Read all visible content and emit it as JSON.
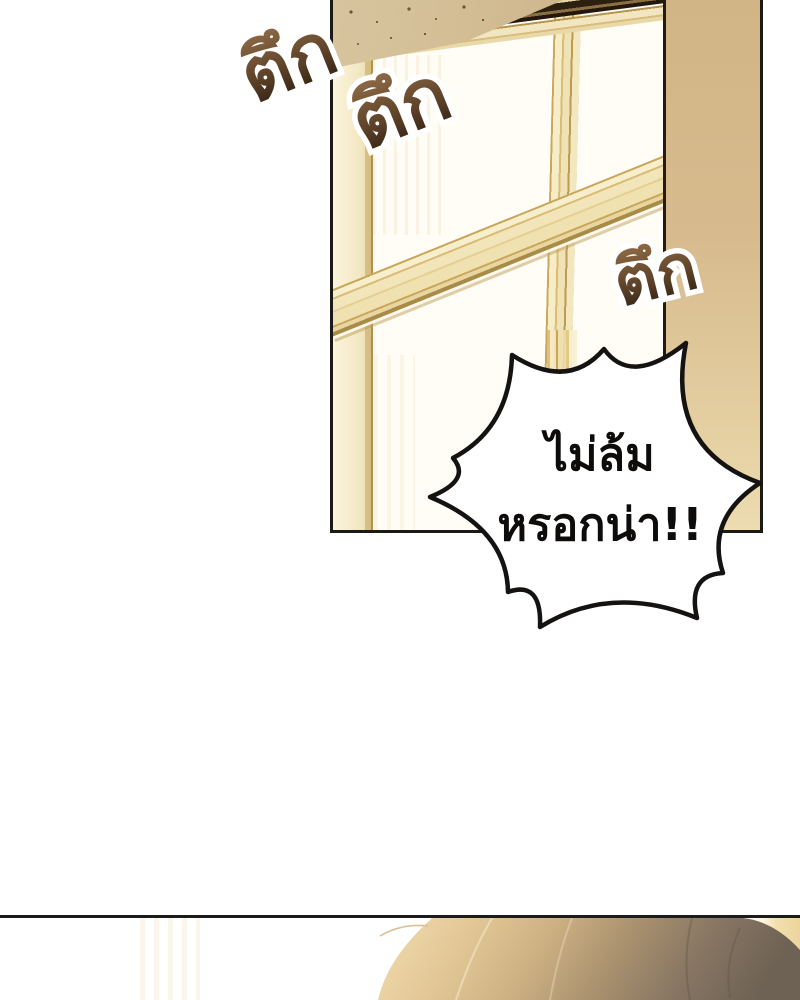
{
  "page": {
    "kind": "webtoon-comic-page",
    "background_color": "#ffffff"
  },
  "sound_effects": [
    {
      "text": "ตึก"
    },
    {
      "text": "ตึก"
    },
    {
      "text": "ตึก"
    }
  ],
  "speech_bubble": {
    "line1": "ไม่ล้ม",
    "line2": "หรอกน่า!!",
    "fill": "#ffffff",
    "stroke": "#151311"
  },
  "colors": {
    "panel_border": "#1c1a17",
    "wall_tan": "#d7bb8e",
    "frame_cream": "#f2e6c0",
    "frame_gold": "#b6954e",
    "glass_white": "#fffdf6",
    "beam_dark": "#2b1d0f",
    "sfx_gradient_top": "#96714b",
    "sfx_gradient_bottom": "#1f140c",
    "hair_light": "#f2ddb0",
    "hair_dark": "#6e6254"
  }
}
